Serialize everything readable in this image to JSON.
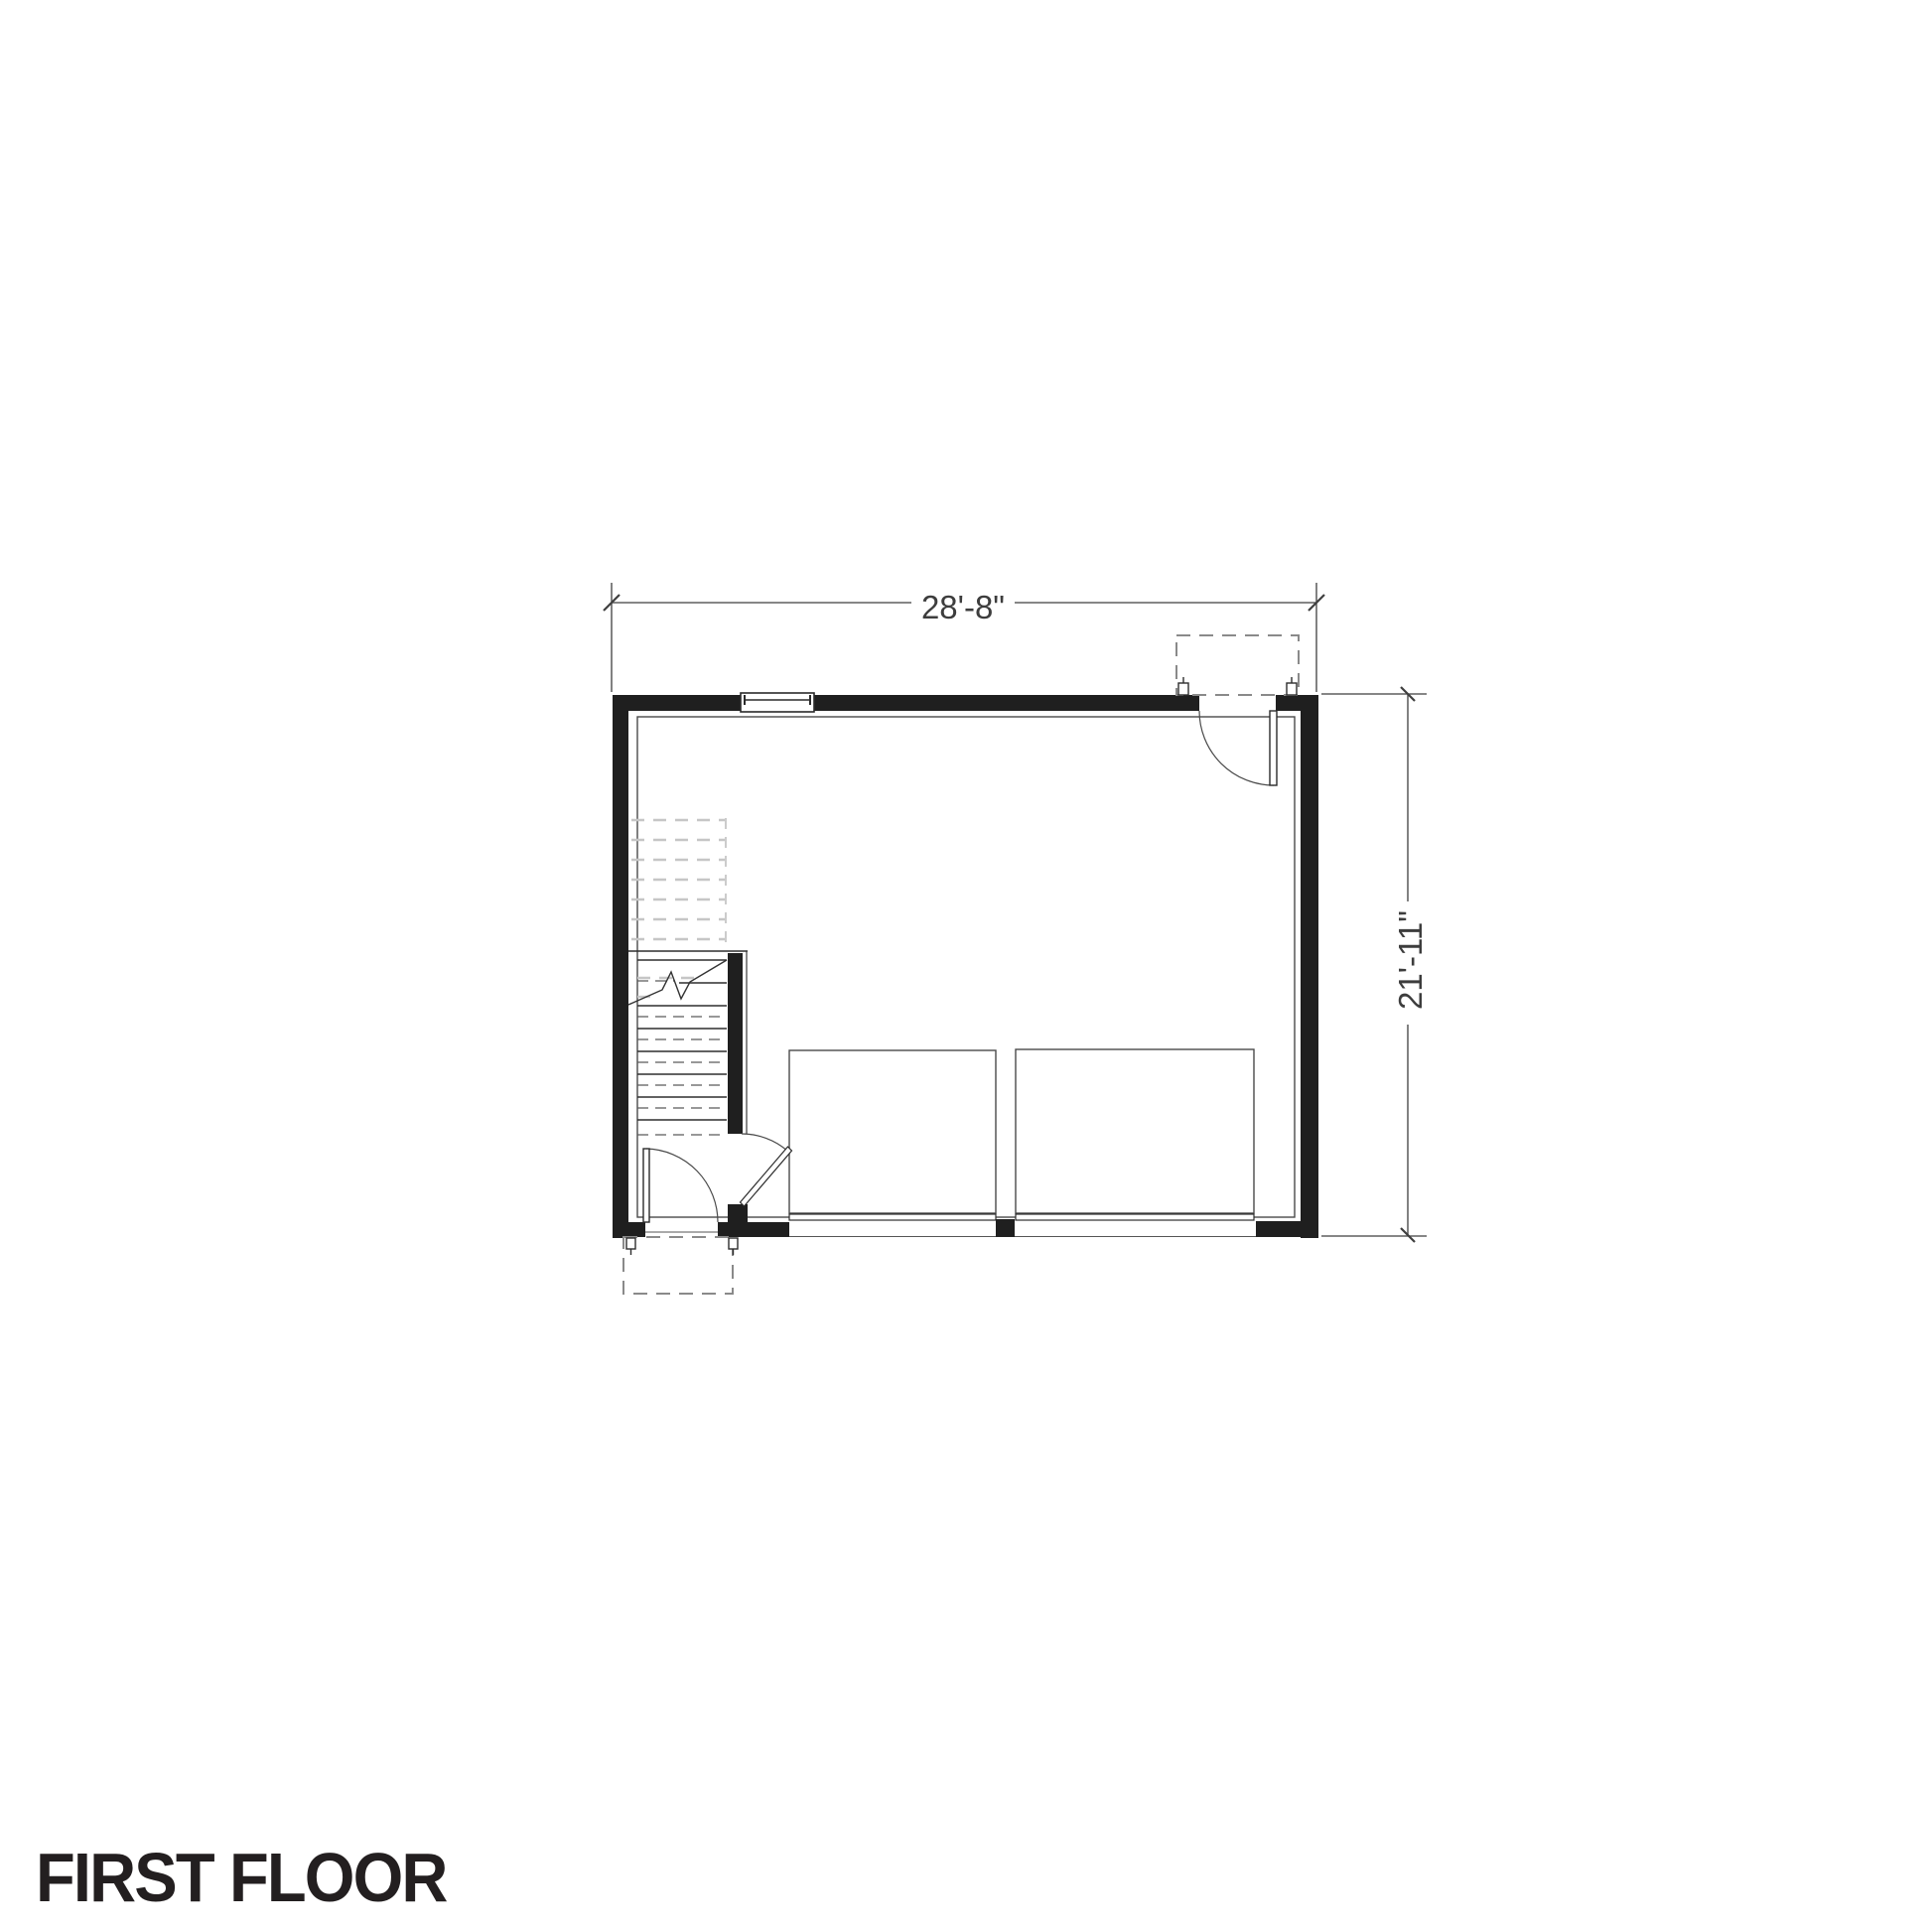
{
  "title": "FIRST FLOOR",
  "dimensions": {
    "width_label": "28'-8\"",
    "height_label": "21'-11\""
  },
  "plan": {
    "type": "floor-plan",
    "floor": "first",
    "rooms": [
      "garage",
      "stair-hall"
    ],
    "features": [
      "window-top-wall",
      "entry-door-top-right-with-stoop",
      "entry-door-bottom-left-with-stoop",
      "stair-flight-with-break-line",
      "stair-to-garage-door",
      "two-overhead-garage-doors"
    ]
  },
  "colors": {
    "background": "#ffffff",
    "wall_fill": "#1f1f1f",
    "line_dark": "#2e2e2e",
    "line_medium": "#4a4a4a",
    "dashed_stoop_gray": "#8a8a8a",
    "stairs_above_light_gray": "#c6c6c6",
    "dimension_text": "#3d3d3d",
    "title_text": "#231f20"
  }
}
